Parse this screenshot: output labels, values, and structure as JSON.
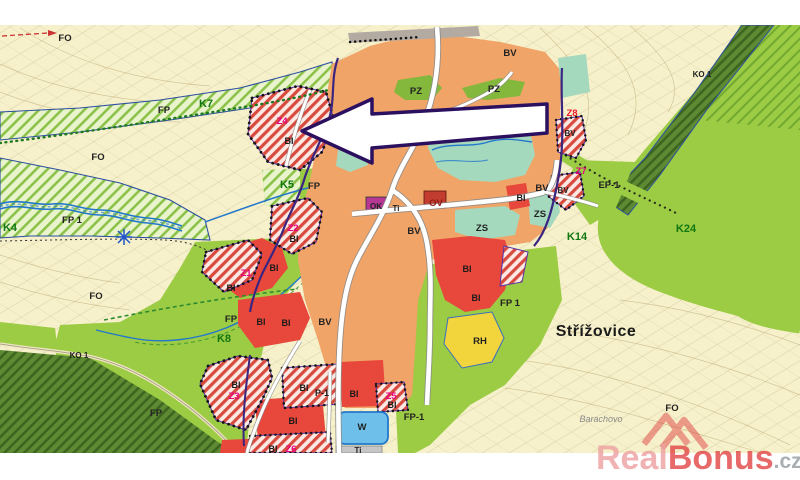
{
  "map": {
    "labels": {
      "fo": "FO",
      "fp": "FP",
      "fp_1": "FP 1",
      "fp_dash_1": "FP-1",
      "ko_1": "KO 1",
      "pz": "PZ",
      "bv": "BV",
      "zs": "ZS",
      "w": "W",
      "ok": "OK",
      "ti": "Ti",
      "rh": "RH",
      "ep_1": "EP-1",
      "p_1": "P-1",
      "ov": "OV",
      "bi": "BI",
      "k4": "K4",
      "k5": "K5",
      "k7": "K7",
      "k8": "K8",
      "k14": "K14",
      "k24": "K24",
      "z1": "Z1",
      "z2": "Z2",
      "z3": "Z3",
      "z4": "Z4",
      "z5": "Z5",
      "z6": "Z6",
      "z7": "Z7",
      "z8": "Z8"
    },
    "places": {
      "city": "Střížovice",
      "locality": "Barachovo"
    },
    "colors": {
      "paper": "#ffffff",
      "field": "#f6f1cb",
      "village_orange": "#f0a468",
      "residential_red": "#e8473b",
      "hatch_red": "#d84a3e",
      "meadow_green": "#9ccb44",
      "forest_green": "#567c2d",
      "park_teal": "#a5d9bd",
      "public_green": "#84b83c",
      "recreation_yellow": "#f2d53c",
      "water_blue": "#6ec0ea",
      "boundary_purple": "#3a2580",
      "zone_label_magenta": "#e6007e",
      "arrow_outline": "#2b1060",
      "watermark_red": "#e24444"
    }
  },
  "watermark": {
    "part_1": "Real",
    "part_2": "Bonus",
    "part_3": ".cz"
  }
}
